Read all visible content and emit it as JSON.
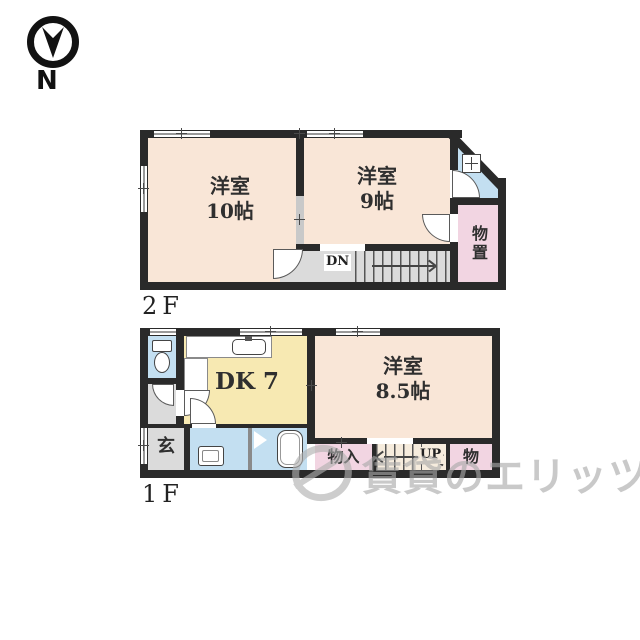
{
  "compass": {
    "label": "N"
  },
  "floor2": {
    "label": "2F",
    "room_west10": {
      "line1": "洋室",
      "line2": "10帖"
    },
    "room_west9": {
      "line1": "洋室",
      "line2": "9帖"
    },
    "storage": {
      "label": "物置"
    },
    "stairs": {
      "label": "DN"
    }
  },
  "floor1": {
    "label": "1F",
    "dk": {
      "label": "DK 7"
    },
    "room_west85": {
      "line1": "洋室",
      "line2": "8.5帖"
    },
    "entrance": {
      "label": "玄"
    },
    "closet": {
      "label": "物入"
    },
    "stairs": {
      "label": "UP"
    },
    "storage": {
      "label": "物"
    }
  },
  "watermark": {
    "text": "賃貸のエリッツ"
  },
  "colors": {
    "wall": "#2a2a2a",
    "room_cream": "#f9e6d7",
    "room_yellow": "#f7e9b2",
    "room_blue": "#c3dff1",
    "room_pink": "#f2d5e2",
    "floor_gray": "#dbdbdb",
    "watermark_gray": "#a9a9a9"
  }
}
